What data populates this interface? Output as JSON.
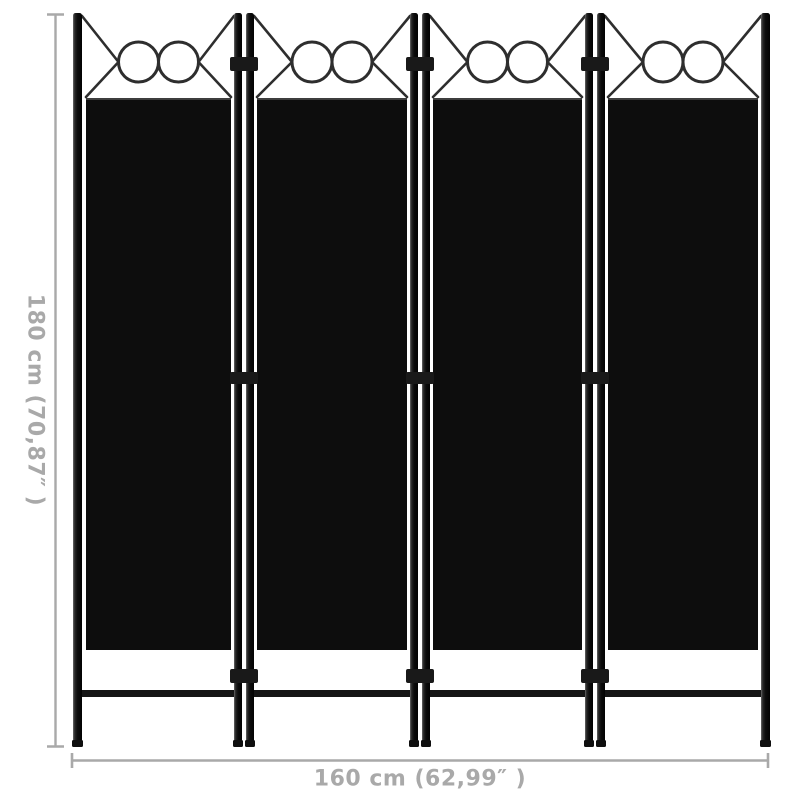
{
  "figure": {
    "subject": "4-panel folding room divider, black",
    "panel_count": 4,
    "rings_per_panel": 2
  },
  "dimensions": {
    "height_label": "180 cm (70,87″ )",
    "width_label": "160 cm (62,99″ )"
  },
  "colors": {
    "background": "#ffffff",
    "frame_black": "#131313",
    "fabric_black": "#0d0d0d",
    "decor_line": "#2e2e2e",
    "dimension_gray": "#a9a9a9"
  }
}
